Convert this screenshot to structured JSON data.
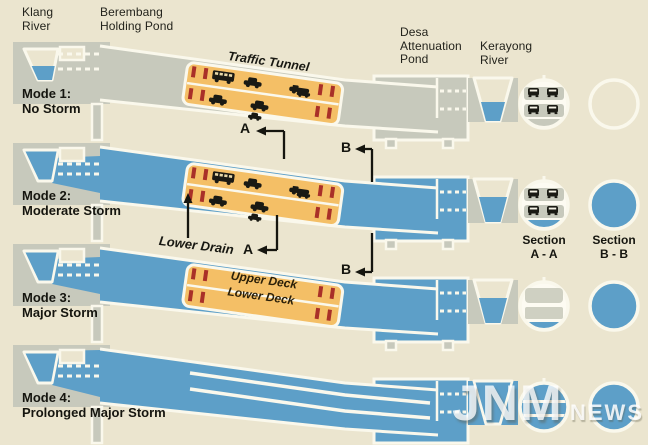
{
  "title": "Storm tunnel operating modes diagram",
  "colors": {
    "background": "#ebe5cf",
    "structure_gray": "#c7c9bc",
    "water_blue": "#5d9fc8",
    "tunnel_orange": "#f4bf66",
    "gate_red": "#a93028",
    "outline_white": "#faf8ec",
    "ink": "#15150f"
  },
  "labels": {
    "klang_river": "Klang\nRiver",
    "berembang": "Berembang\nHolding Pond",
    "traffic_tunnel": "Traffic Tunnel",
    "desa": "Desa\nAttenuation\nPond",
    "kerayong": "Kerayong\nRiver",
    "lower_drain": "Lower Drain",
    "upper_deck": "Upper Deck",
    "lower_deck": "Lower Deck"
  },
  "markers": {
    "a": "A",
    "b": "B"
  },
  "sections": {
    "a_label": "Section\nA - A",
    "b_label": "Section\nB - B"
  },
  "modes": [
    {
      "label": "Mode 1:\nNo Storm",
      "state": "Rivers low, tunnel carries traffic on both decks, lower drain dry, section B-B dry"
    },
    {
      "label": "Mode 2:\nModerate Storm",
      "state": "Stormwater diverted through lower drain beneath traffic decks, section B-B full of water"
    },
    {
      "label": "Mode 3:\nMajor Storm",
      "state": "Tunnel closed to traffic, upper and lower decks evacuated, water in lower drain"
    },
    {
      "label": "Mode 4:\nProlonged Major Storm",
      "state": "Entire tunnel flooded, both decks used to carry stormwater"
    }
  ],
  "watermark": {
    "big": "JNM",
    "small": "NEWS"
  }
}
